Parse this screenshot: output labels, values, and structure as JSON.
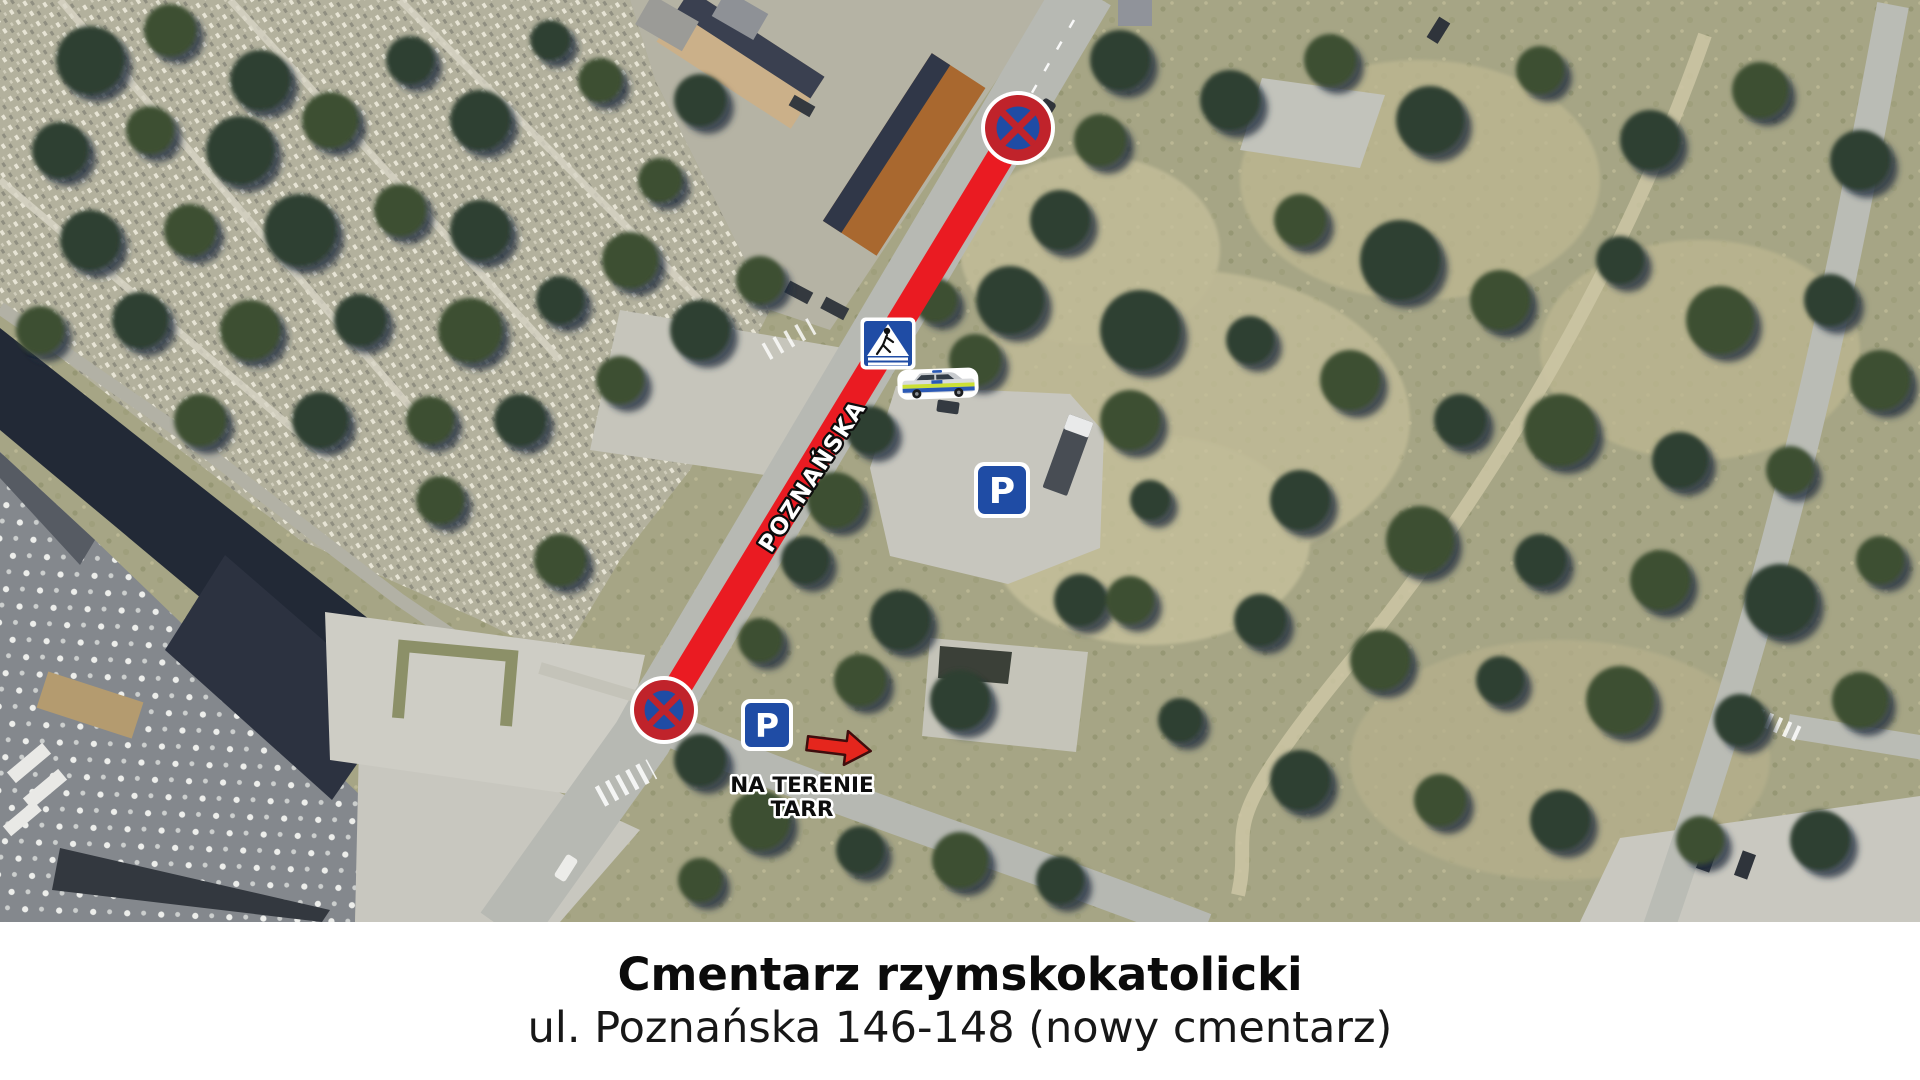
{
  "map": {
    "street_label": "POZNAŃSKA",
    "tarr_note_line1": "NA TERENIE",
    "tarr_note_line2": "TARR",
    "parking_letter": "P",
    "colors": {
      "route_red": "#ea1b22",
      "sign_red": "#c0232b",
      "sign_blue": "#1f4ca5",
      "arrow_red": "#e5261d"
    }
  },
  "caption": {
    "title": "Cmentarz rzymskokatolicki",
    "subtitle": "ul. Poznańska 146-148 (nowy cmentarz)"
  }
}
